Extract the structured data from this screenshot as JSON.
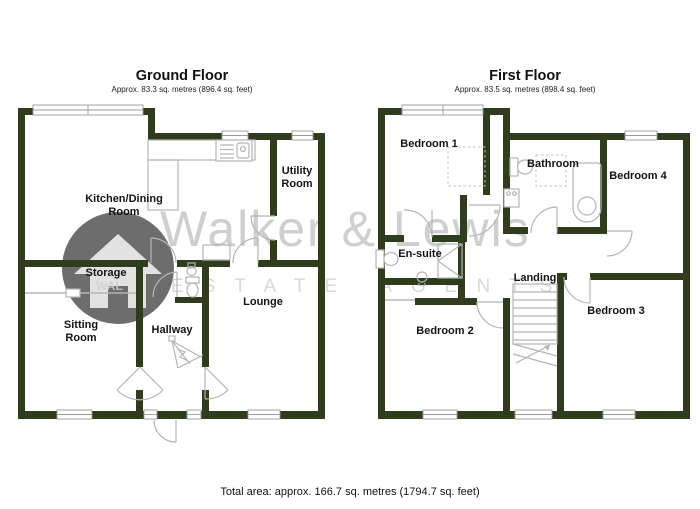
{
  "ground_floor": {
    "title": "Ground Floor",
    "subtitle": "Approx. 83.3 sq. metres (896.4 sq. feet)",
    "rooms": {
      "kitchen_line1": "Kitchen/Dining",
      "kitchen_line2": "Room",
      "utility_line1": "Utility",
      "utility_line2": "Room",
      "storage": "Storage",
      "sitting_line1": "Sitting",
      "sitting_line2": "Room",
      "hallway": "Hallway",
      "lounge": "Lounge"
    }
  },
  "first_floor": {
    "title": "First Floor",
    "subtitle": "Approx. 83.5 sq. metres (898.4 sq. feet)",
    "rooms": {
      "bedroom1": "Bedroom 1",
      "bathroom": "Bathroom",
      "bedroom4": "Bedroom 4",
      "ensuite": "En-suite",
      "landing": "Landing",
      "bedroom2": "Bedroom 2",
      "bedroom3": "Bedroom 3"
    }
  },
  "footer": {
    "total_area": "Total area: approx. 166.7 sq. metres (1794.7 sq. feet)"
  },
  "watermark": {
    "name": "Walker & Lewis",
    "tagline": "ESTATE AGENTS",
    "logo_text": "WAL"
  },
  "colors": {
    "wall": "#2f3d1e",
    "fixture_line": "#b5b5b5",
    "watermark_text": "#cfcfcf",
    "logo_circle": "#4d4d4d"
  }
}
